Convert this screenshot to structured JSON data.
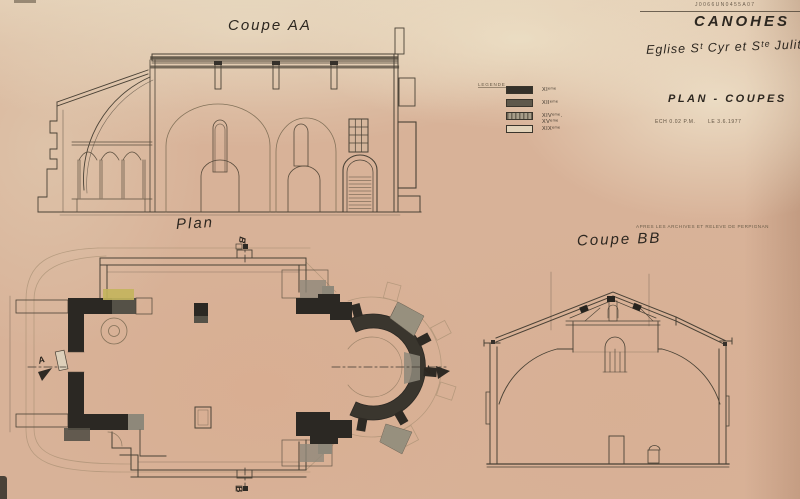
{
  "document": {
    "stamp": "J0066UN0455A07",
    "title": "CANOHES",
    "subtitle": "Eglise Sᵗ Cyr et Sᵗᵉ Julitte",
    "sheet_title": "PLAN - COUPES",
    "scale_note": "ECH 0.02 P.M.",
    "date_note": "LE 3.6.1977",
    "credit_note": "APRES LES ARCHIVES ET RELEVE DE PERPIGNAN"
  },
  "labels": {
    "section_aa": "Coupe AA",
    "plan": "Plan",
    "section_bb": "Coupe BB"
  },
  "legend": {
    "title": "LEGENDE",
    "items": [
      {
        "label": "XIᵉᵐᵉ",
        "color": "#35312a",
        "style": "solid-black"
      },
      {
        "label": "XIIᵉᵐᵉ",
        "color": "#5e584b",
        "style": "solid-gray"
      },
      {
        "label": "XIVᵉᵐᵉ. XVᵉᵐᵉ",
        "color": "#a89e8a",
        "style": "hatched"
      },
      {
        "label": "XIXᵉᵐᵉ",
        "color": "#e2d3ba",
        "style": "outline"
      }
    ]
  },
  "section_markers": {
    "a": "A",
    "b": "B"
  },
  "colors": {
    "paper": "#d8b298",
    "ink": "#2d2720",
    "wall_black": "#2b2823",
    "wall_darkgray": "#555147",
    "wall_lightgray": "#97907e",
    "highlight_yellow": "#c3b45c"
  }
}
